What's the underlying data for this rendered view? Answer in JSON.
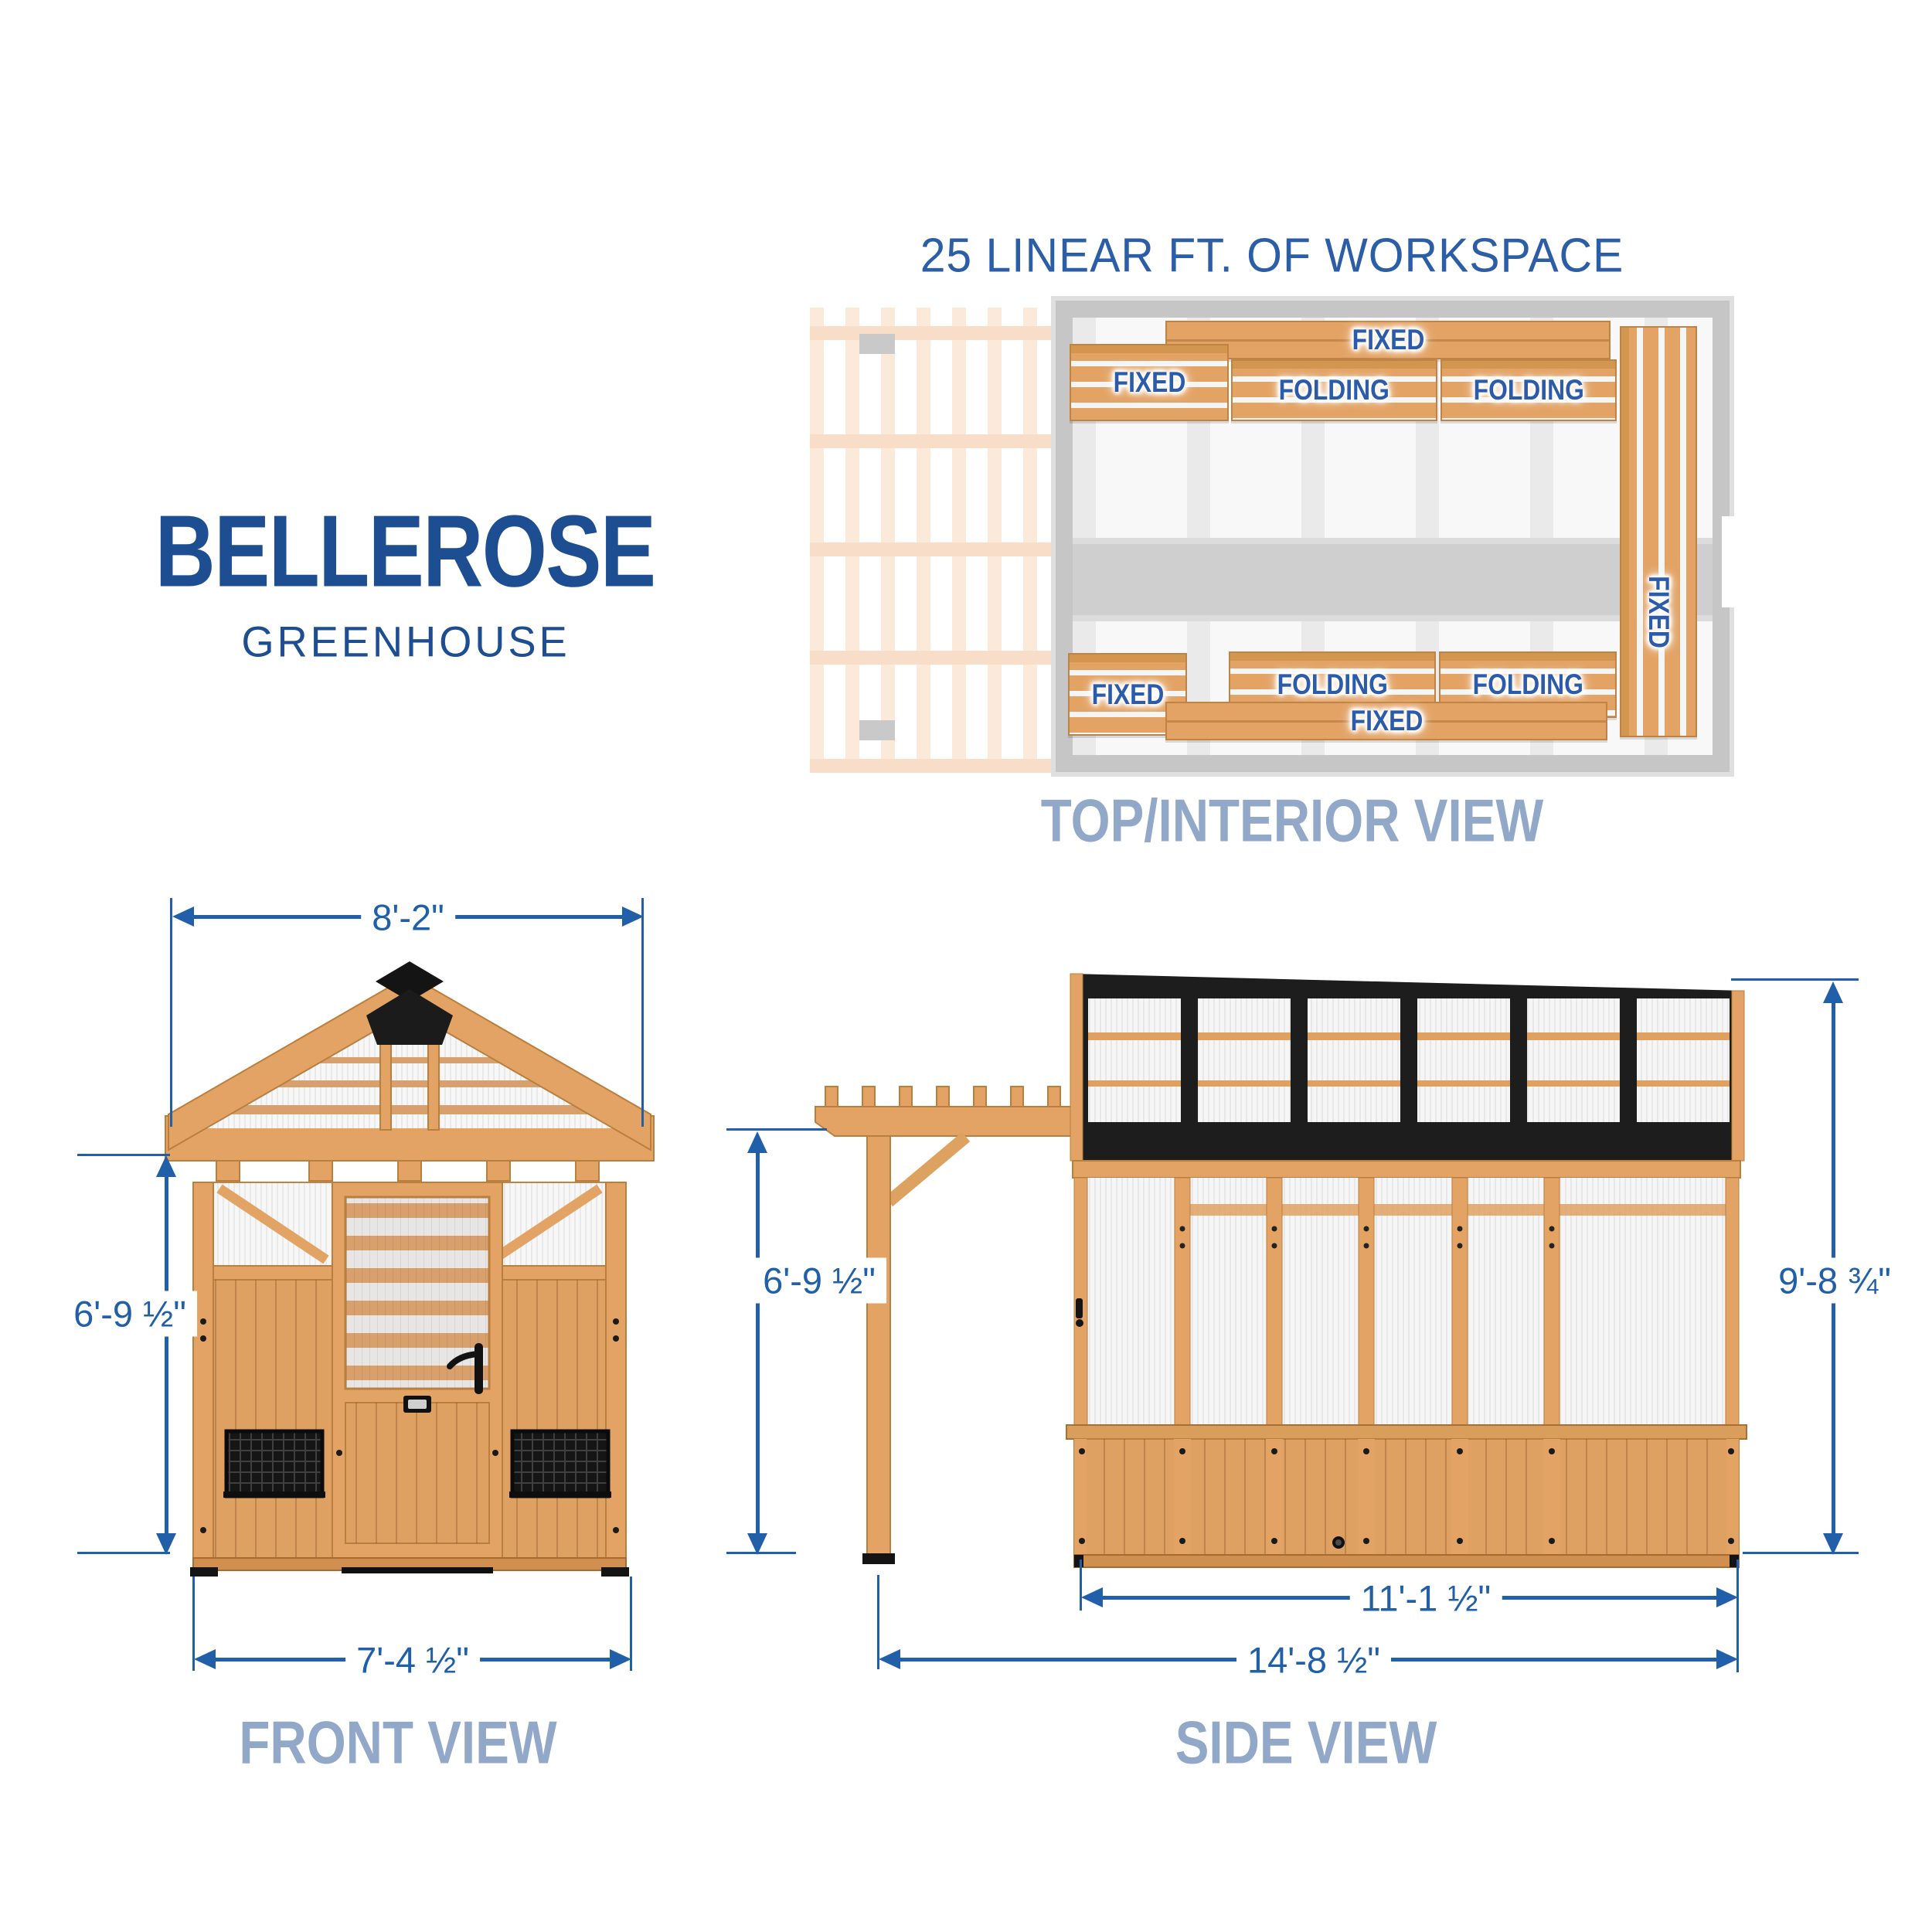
{
  "brand": {
    "title": "BELLEROSE",
    "subtitle": "GREENHOUSE"
  },
  "top_view": {
    "heading": "25 LINEAR FT. OF WORKSPACE",
    "caption": "TOP/INTERIOR VIEW",
    "benches": {
      "top_long": "FIXED",
      "row_fixed": "FIXED",
      "row_folding_1": "FOLDING",
      "row_folding_2": "FOLDING",
      "right_vertical": "FIXED",
      "bottom_fixed_small": "FIXED",
      "bottom_folding_1": "FOLDING",
      "bottom_folding_2": "FOLDING",
      "bottom_long": "FIXED"
    }
  },
  "front_view": {
    "caption": "FRONT VIEW",
    "dims": {
      "width": "8'-2\"",
      "height": "6'-9 ½\"",
      "base_width": "7'-4 ½\""
    }
  },
  "side_view": {
    "caption": "SIDE VIEW",
    "dims": {
      "pergola_height": "6'-9 ½\"",
      "total_height": "9'-8 ¾\"",
      "house_length": "11'-1 ½\"",
      "total_length": "14'-8 ½\""
    }
  },
  "colors": {
    "brand_navy": "#1e4e92",
    "dimension_blue": "#2160a8",
    "caption_slate": "#92a8c9",
    "bench_label_blue": "#2a5cab",
    "wood": "#e3a365",
    "wood_dark": "#b97f3f",
    "wood_faded": "#fbe9da",
    "frame_black": "#1d1d1d"
  }
}
